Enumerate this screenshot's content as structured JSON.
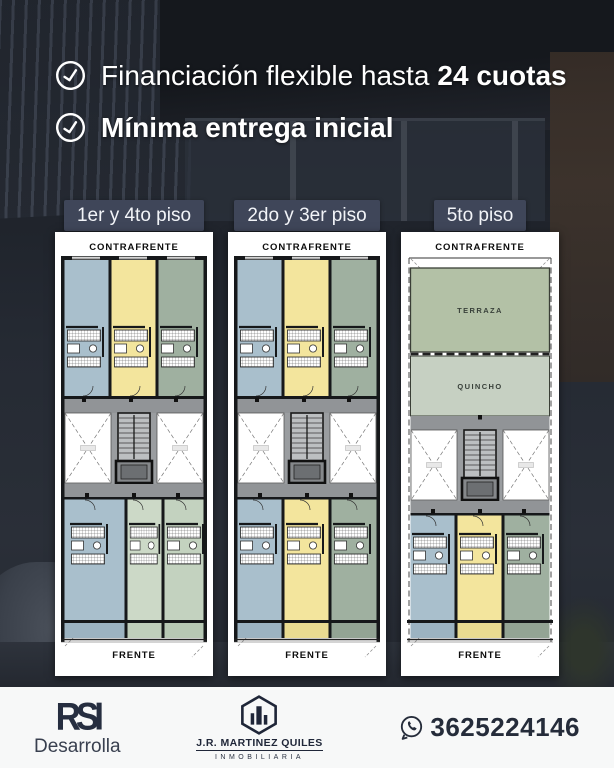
{
  "benefits": {
    "items": [
      {
        "regular": "Financiación flexible hasta",
        "bold": "24 cuotas"
      },
      {
        "regular": "",
        "bold": "Mínima entrega inicial"
      }
    ]
  },
  "plans": [
    {
      "title": "1er y 4to piso",
      "top": "CONTRAFRENTE",
      "bottom": "FRENTE"
    },
    {
      "title": "2do y 3er piso",
      "top": "CONTRAFRENTE",
      "bottom": "FRENTE"
    },
    {
      "title": "5to piso",
      "top": "CONTRAFRENTE",
      "bottom": "FRENTE",
      "areas": {
        "terraza": "TERRAZA",
        "quincho": "QUINCHO"
      }
    }
  ],
  "footer": {
    "developer": {
      "logo_text": "RSI",
      "name": "Desarrolla"
    },
    "agency": {
      "name": "J.R. MARTINEZ QUILES",
      "subtitle": "INMOBILIARIA"
    },
    "contact": {
      "phone": "3625224146"
    }
  },
  "colors": {
    "pill_slate": "#3f4659",
    "unit_blue": "#a9bfcc",
    "unit_yellow": "#f3e59d",
    "unit_green": "#9fb0a0",
    "unit_green_light": "#ccd9c7",
    "terraza_green": "#b3c1a6",
    "quincho_green": "#c6d0c2",
    "corridor_gray": "#919497",
    "footer_bg": "#f7f8f8",
    "navy_text": "#252c3a"
  }
}
